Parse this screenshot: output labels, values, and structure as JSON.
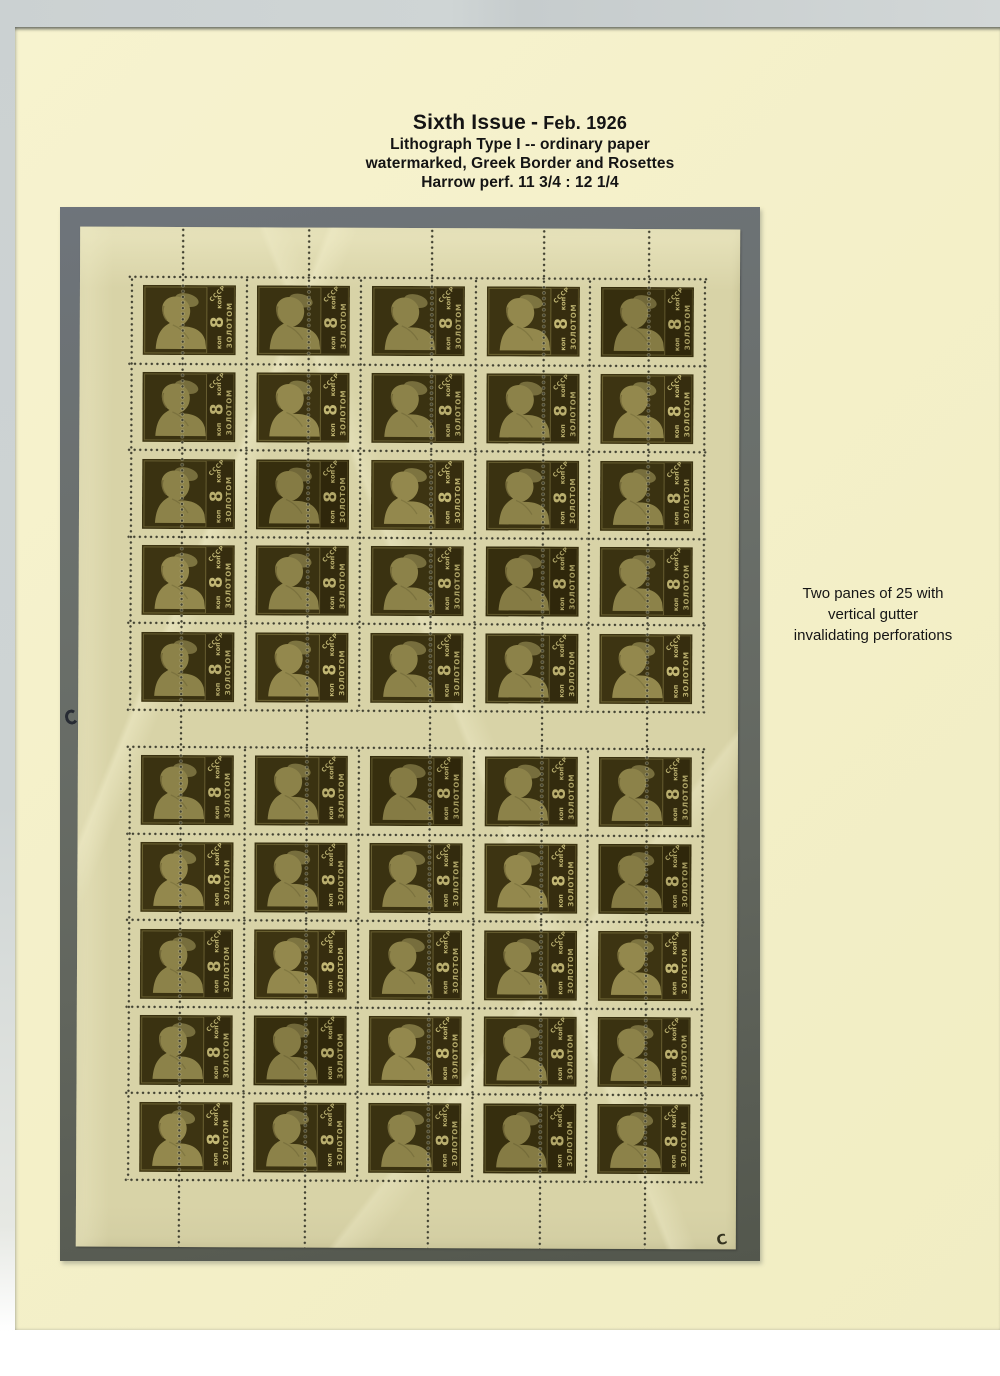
{
  "header": {
    "title": "Sixth Issue",
    "separator": "-",
    "date": "Feb. 1926",
    "subtitle1": "Lithograph Type I -- ordinary paper",
    "subtitle2": "watermarked, Greek Border and Rosettes",
    "subtitle3": "Harrow perf. 11 3/4 : 12 1/4"
  },
  "annotation": {
    "line1": "Two panes of 25 with",
    "line2": "vertical gutter",
    "line3": "invalidating perforations"
  },
  "sheet": {
    "panes": 2,
    "rows": 5,
    "cols": 5,
    "stamps_per_pane": 25,
    "stamp": {
      "value": "8",
      "currency": "коп",
      "inscription": "ЗОЛОТОМ",
      "country": "СССР"
    },
    "marks": {
      "bottom_right_control": "C"
    }
  },
  "colors": {
    "scan_background": "#cdd3d3",
    "album_page": "#f4f0c9",
    "mount_mat": "#666b63",
    "sheet_paper": "#d8d3a7",
    "stamp_ink": "#3a3211",
    "stamp_portrait": "#8c8249",
    "stamp_lettering": "#b9ae6e",
    "text": "#141414"
  }
}
